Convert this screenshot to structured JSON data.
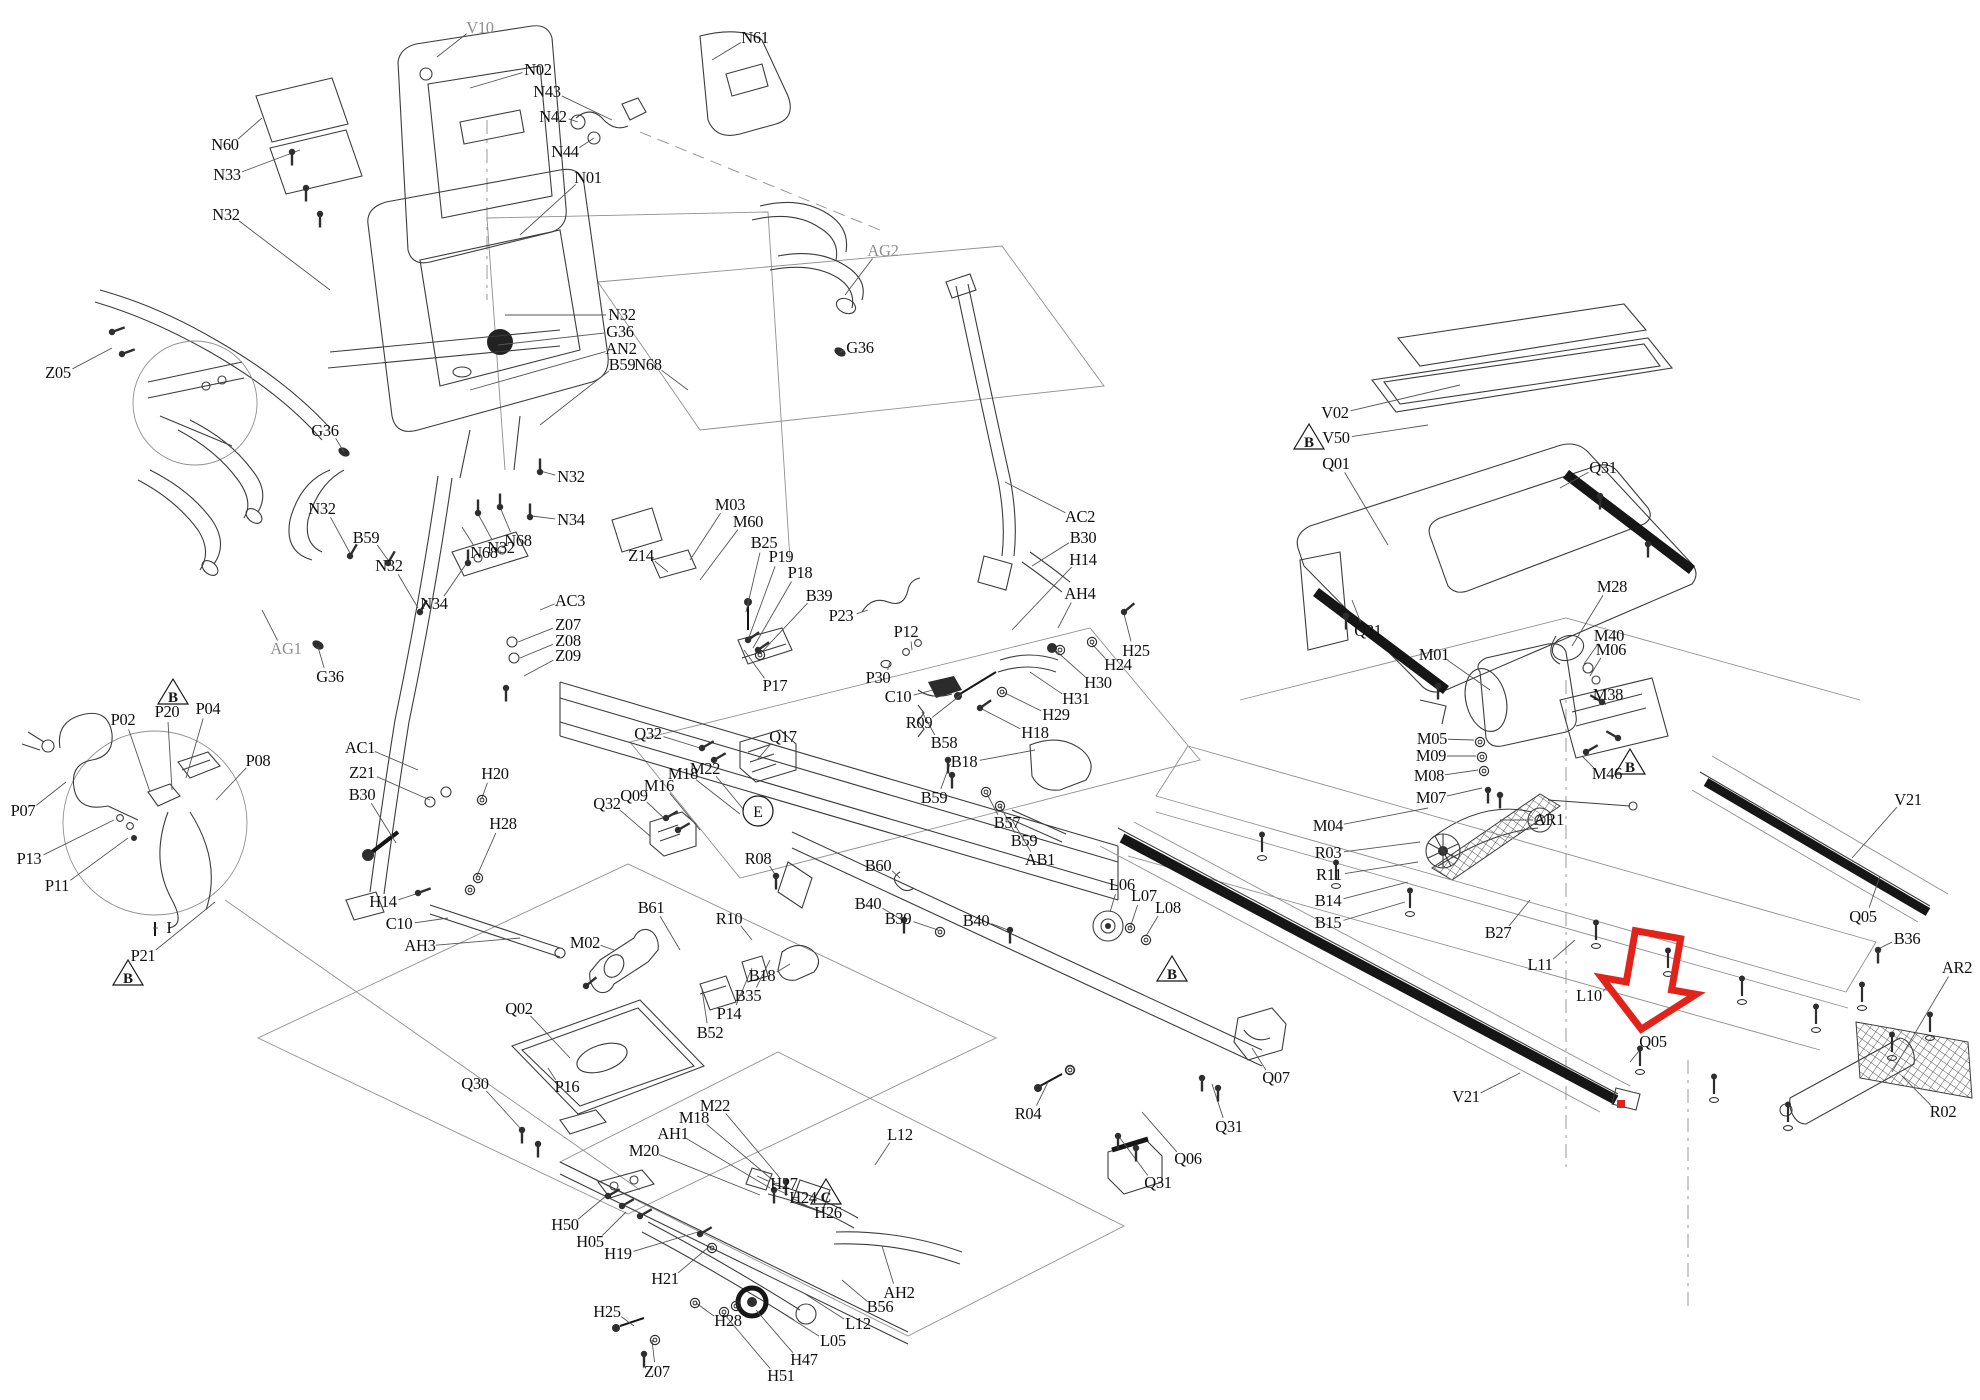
{
  "figure": {
    "type": "exploded-parts-diagram",
    "subject": "treadmill assembly"
  },
  "highlight": {
    "color": "#e2231a",
    "arrow": {
      "x": 1650,
      "y": 980,
      "rotate": 10
    },
    "dot": {
      "x": 1621,
      "y": 1104,
      "size": 8
    }
  },
  "markers": {
    "triangles": [
      {
        "x": 173,
        "y": 693,
        "letter": "B"
      },
      {
        "x": 128,
        "y": 974,
        "letter": "B"
      },
      {
        "x": 826,
        "y": 1193,
        "letter": "C"
      },
      {
        "x": 1172,
        "y": 970,
        "letter": "B"
      },
      {
        "x": 1309,
        "y": 438,
        "letter": "B"
      },
      {
        "x": 1630,
        "y": 763,
        "letter": "B"
      }
    ],
    "circles": [
      {
        "x": 758,
        "y": 811,
        "letter": "E"
      }
    ]
  },
  "labels": [
    {
      "t": "V10",
      "x": 480,
      "y": 28,
      "l": [
        437,
        57
      ],
      "c": "gray"
    },
    {
      "t": "N02",
      "x": 538,
      "y": 70,
      "l": [
        470,
        88
      ]
    },
    {
      "t": "N43",
      "x": 547,
      "y": 92,
      "l": [
        612,
        120
      ]
    },
    {
      "t": "N42",
      "x": 553,
      "y": 117,
      "l": [
        578,
        122
      ]
    },
    {
      "t": "N44",
      "x": 565,
      "y": 152,
      "l": [
        594,
        138
      ]
    },
    {
      "t": "N61",
      "x": 755,
      "y": 38,
      "l": [
        712,
        60
      ]
    },
    {
      "t": "N01",
      "x": 588,
      "y": 178,
      "l": [
        520,
        235
      ]
    },
    {
      "t": "N60",
      "x": 225,
      "y": 145,
      "l": [
        262,
        118
      ]
    },
    {
      "t": "N33",
      "x": 227,
      "y": 175,
      "l": [
        300,
        150
      ]
    },
    {
      "t": "N32",
      "x": 226,
      "y": 215,
      "l": [
        330,
        290
      ]
    },
    {
      "t": "N32",
      "x": 622,
      "y": 315,
      "l": [
        505,
        315
      ]
    },
    {
      "t": "G36",
      "x": 620,
      "y": 332,
      "l": [
        498,
        345
      ]
    },
    {
      "t": "AN2",
      "x": 621,
      "y": 349,
      "l": [
        470,
        390
      ]
    },
    {
      "t": "B59",
      "x": 622,
      "y": 365,
      "l": [
        540,
        425
      ]
    },
    {
      "t": "N68",
      "x": 648,
      "y": 365,
      "l": [
        688,
        390
      ]
    },
    {
      "t": "G36",
      "x": 860,
      "y": 348,
      "l": [
        840,
        352
      ]
    },
    {
      "t": "AG2",
      "x": 883,
      "y": 251,
      "l": [
        845,
        295
      ],
      "c": "gray"
    },
    {
      "t": "Z05",
      "x": 58,
      "y": 373,
      "l": [
        112,
        348
      ]
    },
    {
      "t": "G36",
      "x": 325,
      "y": 431,
      "l": [
        344,
        452
      ]
    },
    {
      "t": "N32",
      "x": 322,
      "y": 509,
      "l": [
        350,
        553
      ]
    },
    {
      "t": "B59",
      "x": 366,
      "y": 538,
      "l": [
        388,
        560
      ]
    },
    {
      "t": "N32",
      "x": 389,
      "y": 566,
      "l": [
        418,
        608
      ]
    },
    {
      "t": "N34",
      "x": 434,
      "y": 604,
      "l": [
        466,
        564
      ]
    },
    {
      "t": "N68",
      "x": 484,
      "y": 553,
      "l": [
        462,
        527
      ]
    },
    {
      "t": "N32",
      "x": 501,
      "y": 548,
      "l": [
        478,
        514
      ]
    },
    {
      "t": "N68",
      "x": 518,
      "y": 541,
      "l": [
        500,
        507
      ]
    },
    {
      "t": "N32",
      "x": 571,
      "y": 477,
      "l": [
        540,
        471
      ]
    },
    {
      "t": "N34",
      "x": 571,
      "y": 520,
      "l": [
        532,
        516
      ]
    },
    {
      "t": "AC3",
      "x": 570,
      "y": 601,
      "l": [
        540,
        610
      ]
    },
    {
      "t": "Z07",
      "x": 568,
      "y": 625,
      "l": [
        518,
        642
      ]
    },
    {
      "t": "Z08",
      "x": 568,
      "y": 641,
      "l": [
        520,
        658
      ]
    },
    {
      "t": "Z09",
      "x": 568,
      "y": 656,
      "l": [
        524,
        676
      ]
    },
    {
      "t": "AG1",
      "x": 286,
      "y": 649,
      "l": [
        262,
        610
      ],
      "c": "gray"
    },
    {
      "t": "G36",
      "x": 330,
      "y": 677,
      "l": [
        318,
        647
      ]
    },
    {
      "t": "Z14",
      "x": 641,
      "y": 556,
      "l": [
        668,
        572
      ]
    },
    {
      "t": "M03",
      "x": 730,
      "y": 505,
      "l": [
        690,
        560
      ]
    },
    {
      "t": "M60",
      "x": 748,
      "y": 522,
      "l": [
        700,
        580
      ]
    },
    {
      "t": "B25",
      "x": 764,
      "y": 543,
      "l": [
        746,
        612
      ]
    },
    {
      "t": "P19",
      "x": 781,
      "y": 557,
      "l": [
        748,
        640
      ]
    },
    {
      "t": "P18",
      "x": 800,
      "y": 573,
      "l": [
        753,
        648
      ]
    },
    {
      "t": "B39",
      "x": 819,
      "y": 596,
      "l": [
        760,
        654
      ]
    },
    {
      "t": "P23",
      "x": 841,
      "y": 616,
      "l": [
        868,
        610
      ]
    },
    {
      "t": "P12",
      "x": 906,
      "y": 632,
      "l": [
        912,
        650
      ]
    },
    {
      "t": "P30",
      "x": 878,
      "y": 678,
      "l": [
        890,
        662
      ]
    },
    {
      "t": "C10",
      "x": 898,
      "y": 697,
      "l": [
        933,
        690
      ]
    },
    {
      "t": "P17",
      "x": 775,
      "y": 686,
      "l": [
        744,
        650
      ]
    },
    {
      "t": "R09",
      "x": 919,
      "y": 723,
      "l": [
        962,
        694
      ]
    },
    {
      "t": "AC2",
      "x": 1080,
      "y": 517,
      "l": [
        1005,
        482
      ]
    },
    {
      "t": "B30",
      "x": 1083,
      "y": 538,
      "l": [
        1032,
        566
      ]
    },
    {
      "t": "H14",
      "x": 1083,
      "y": 560,
      "l": [
        1012,
        630
      ]
    },
    {
      "t": "AH4",
      "x": 1080,
      "y": 594,
      "l": [
        1058,
        628
      ]
    },
    {
      "t": "H25",
      "x": 1136,
      "y": 651,
      "l": [
        1124,
        614
      ]
    },
    {
      "t": "H24",
      "x": 1118,
      "y": 665,
      "l": [
        1092,
        644
      ]
    },
    {
      "t": "H30",
      "x": 1098,
      "y": 683,
      "l": [
        1055,
        650
      ]
    },
    {
      "t": "H31",
      "x": 1076,
      "y": 699,
      "l": [
        1030,
        672
      ]
    },
    {
      "t": "H29",
      "x": 1056,
      "y": 715,
      "l": [
        1003,
        692
      ]
    },
    {
      "t": "H18",
      "x": 1035,
      "y": 733,
      "l": [
        980,
        708
      ]
    },
    {
      "t": "B58",
      "x": 944,
      "y": 743,
      "l": [
        922,
        712
      ]
    },
    {
      "t": "B18",
      "x": 964,
      "y": 762,
      "l": [
        1035,
        750
      ]
    },
    {
      "t": "B59",
      "x": 934,
      "y": 798,
      "l": [
        950,
        764
      ]
    },
    {
      "t": "B57",
      "x": 1007,
      "y": 823,
      "l": [
        987,
        794
      ]
    },
    {
      "t": "B59",
      "x": 1024,
      "y": 841,
      "l": [
        1000,
        806
      ]
    },
    {
      "t": "AB1",
      "x": 1040,
      "y": 860,
      "l": [
        1012,
        820
      ]
    },
    {
      "t": "B60",
      "x": 878,
      "y": 866,
      "l": [
        900,
        878
      ]
    },
    {
      "t": "B40",
      "x": 868,
      "y": 904,
      "l": [
        902,
        920
      ]
    },
    {
      "t": "B39",
      "x": 898,
      "y": 919,
      "l": [
        938,
        930
      ]
    },
    {
      "t": "B40",
      "x": 976,
      "y": 921,
      "l": [
        1008,
        930
      ]
    },
    {
      "t": "L06",
      "x": 1122,
      "y": 885,
      "l": [
        1110,
        912
      ]
    },
    {
      "t": "L07",
      "x": 1144,
      "y": 896,
      "l": [
        1130,
        928
      ]
    },
    {
      "t": "L08",
      "x": 1168,
      "y": 908,
      "l": [
        1146,
        936
      ]
    },
    {
      "t": "AC1",
      "x": 360,
      "y": 748,
      "l": [
        418,
        770
      ]
    },
    {
      "t": "Z21",
      "x": 362,
      "y": 773,
      "l": [
        430,
        800
      ]
    },
    {
      "t": "B30",
      "x": 362,
      "y": 795,
      "l": [
        396,
        843
      ]
    },
    {
      "t": "H20",
      "x": 495,
      "y": 774,
      "l": [
        482,
        798
      ]
    },
    {
      "t": "H28",
      "x": 503,
      "y": 824,
      "l": [
        476,
        878
      ]
    },
    {
      "t": "H14",
      "x": 383,
      "y": 902,
      "l": [
        416,
        894
      ]
    },
    {
      "t": "C10",
      "x": 399,
      "y": 924,
      "l": [
        448,
        918
      ]
    },
    {
      "t": "AH3",
      "x": 420,
      "y": 946,
      "l": [
        520,
        938
      ]
    },
    {
      "t": "Q32",
      "x": 648,
      "y": 734,
      "l": [
        700,
        748
      ]
    },
    {
      "t": "Q17",
      "x": 783,
      "y": 737,
      "l": [
        757,
        760
      ]
    },
    {
      "t": "M22",
      "x": 705,
      "y": 769,
      "l": [
        744,
        810
      ]
    },
    {
      "t": "M18",
      "x": 683,
      "y": 774,
      "l": [
        740,
        814
      ]
    },
    {
      "t": "M16",
      "x": 659,
      "y": 786,
      "l": [
        700,
        830
      ]
    },
    {
      "t": "Q09",
      "x": 634,
      "y": 796,
      "l": [
        666,
        820
      ]
    },
    {
      "t": "Q32",
      "x": 607,
      "y": 804,
      "l": [
        650,
        836
      ]
    },
    {
      "t": "R08",
      "x": 758,
      "y": 859,
      "l": [
        776,
        876
      ]
    },
    {
      "t": "R10",
      "x": 729,
      "y": 919,
      "l": [
        752,
        940
      ]
    },
    {
      "t": "B61",
      "x": 651,
      "y": 908,
      "l": [
        680,
        950
      ]
    },
    {
      "t": "M02",
      "x": 585,
      "y": 943,
      "l": [
        614,
        950
      ]
    },
    {
      "t": "B18",
      "x": 762,
      "y": 976,
      "l": [
        790,
        964
      ]
    },
    {
      "t": "B35",
      "x": 748,
      "y": 996,
      "l": [
        770,
        960
      ]
    },
    {
      "t": "P14",
      "x": 729,
      "y": 1014,
      "l": [
        752,
        968
      ]
    },
    {
      "t": "B52",
      "x": 710,
      "y": 1033,
      "l": [
        702,
        990
      ]
    },
    {
      "t": "Q02",
      "x": 519,
      "y": 1009,
      "l": [
        570,
        1058
      ]
    },
    {
      "t": "P16",
      "x": 567,
      "y": 1087,
      "l": [
        548,
        1068
      ]
    },
    {
      "t": "Q30",
      "x": 475,
      "y": 1084,
      "l": [
        520,
        1128
      ]
    },
    {
      "t": "M22",
      "x": 715,
      "y": 1106,
      "l": [
        780,
        1178
      ]
    },
    {
      "t": "M18",
      "x": 694,
      "y": 1118,
      "l": [
        775,
        1182
      ]
    },
    {
      "t": "AH1",
      "x": 673,
      "y": 1134,
      "l": [
        770,
        1188
      ]
    },
    {
      "t": "M20",
      "x": 644,
      "y": 1151,
      "l": [
        760,
        1195
      ]
    },
    {
      "t": "L12",
      "x": 900,
      "y": 1135,
      "l": [
        875,
        1165
      ]
    },
    {
      "t": "H27",
      "x": 784,
      "y": 1184,
      "l": [
        757,
        1176
      ]
    },
    {
      "t": "H24",
      "x": 803,
      "y": 1198,
      "l": [
        774,
        1188
      ]
    },
    {
      "t": "H26",
      "x": 828,
      "y": 1213,
      "l": [
        792,
        1198
      ]
    },
    {
      "t": "H50",
      "x": 565,
      "y": 1225,
      "l": [
        606,
        1196
      ]
    },
    {
      "t": "H05",
      "x": 590,
      "y": 1242,
      "l": [
        626,
        1212
      ]
    },
    {
      "t": "H19",
      "x": 618,
      "y": 1254,
      "l": [
        698,
        1232
      ]
    },
    {
      "t": "H21",
      "x": 665,
      "y": 1279,
      "l": [
        710,
        1246
      ]
    },
    {
      "t": "H25",
      "x": 607,
      "y": 1312,
      "l": [
        634,
        1326
      ]
    },
    {
      "t": "H28",
      "x": 728,
      "y": 1321,
      "l": [
        696,
        1303
      ]
    },
    {
      "t": "Z07",
      "x": 657,
      "y": 1372,
      "l": [
        652,
        1340
      ]
    },
    {
      "t": "H51",
      "x": 781,
      "y": 1376,
      "l": [
        724,
        1314
      ]
    },
    {
      "t": "H47",
      "x": 804,
      "y": 1360,
      "l": [
        756,
        1310
      ]
    },
    {
      "t": "L05",
      "x": 833,
      "y": 1341,
      "l": [
        784,
        1314
      ]
    },
    {
      "t": "L12",
      "x": 858,
      "y": 1324,
      "l": [
        802,
        1292
      ]
    },
    {
      "t": "B56",
      "x": 880,
      "y": 1307,
      "l": [
        842,
        1280
      ]
    },
    {
      "t": "AH2",
      "x": 899,
      "y": 1293,
      "l": [
        882,
        1246
      ]
    },
    {
      "t": "R04",
      "x": 1028,
      "y": 1114,
      "l": [
        1048,
        1082
      ]
    },
    {
      "t": "Q06",
      "x": 1188,
      "y": 1159,
      "l": [
        1142,
        1112
      ]
    },
    {
      "t": "Q31",
      "x": 1158,
      "y": 1183,
      "l": [
        1120,
        1138
      ]
    },
    {
      "t": "Q31",
      "x": 1229,
      "y": 1127,
      "l": [
        1212,
        1084
      ]
    },
    {
      "t": "Q07",
      "x": 1276,
      "y": 1078,
      "l": [
        1252,
        1048
      ]
    },
    {
      "t": "P02",
      "x": 123,
      "y": 720,
      "l": [
        150,
        792
      ]
    },
    {
      "t": "P20",
      "x": 167,
      "y": 712,
      "l": [
        172,
        790
      ]
    },
    {
      "t": "P04",
      "x": 208,
      "y": 709,
      "l": [
        186,
        778
      ]
    },
    {
      "t": "P08",
      "x": 258,
      "y": 761,
      "l": [
        216,
        800
      ]
    },
    {
      "t": "P07",
      "x": 23,
      "y": 811,
      "l": [
        66,
        782
      ]
    },
    {
      "t": "P13",
      "x": 29,
      "y": 859,
      "l": [
        114,
        820
      ]
    },
    {
      "t": "P11",
      "x": 57,
      "y": 886,
      "l": [
        128,
        838
      ]
    },
    {
      "t": "I",
      "x": 169,
      "y": 928,
      "l": [
        158,
        928
      ]
    },
    {
      "t": "P21",
      "x": 143,
      "y": 956,
      "l": [
        215,
        902
      ]
    },
    {
      "t": "V02",
      "x": 1335,
      "y": 413,
      "l": [
        1460,
        385
      ]
    },
    {
      "t": "V50",
      "x": 1336,
      "y": 438,
      "l": [
        1428,
        425
      ]
    },
    {
      "t": "Q01",
      "x": 1336,
      "y": 464,
      "l": [
        1388,
        545
      ]
    },
    {
      "t": "Q31",
      "x": 1603,
      "y": 468,
      "l": [
        1560,
        488
      ]
    },
    {
      "t": "Q31",
      "x": 1368,
      "y": 631,
      "l": [
        1352,
        600
      ]
    },
    {
      "t": "M28",
      "x": 1612,
      "y": 587,
      "l": [
        1572,
        646
      ]
    },
    {
      "t": "M40",
      "x": 1609,
      "y": 636,
      "l": [
        1584,
        664
      ]
    },
    {
      "t": "M06",
      "x": 1611,
      "y": 650,
      "l": [
        1590,
        676
      ]
    },
    {
      "t": "M01",
      "x": 1434,
      "y": 655,
      "l": [
        1490,
        690
      ]
    },
    {
      "t": "M38",
      "x": 1608,
      "y": 695,
      "l": [
        1606,
        704
      ]
    },
    {
      "t": "M05",
      "x": 1432,
      "y": 739,
      "l": [
        1474,
        740
      ]
    },
    {
      "t": "M09",
      "x": 1431,
      "y": 756,
      "l": [
        1476,
        756
      ]
    },
    {
      "t": "M08",
      "x": 1429,
      "y": 776,
      "l": [
        1478,
        770
      ]
    },
    {
      "t": "M07",
      "x": 1431,
      "y": 798,
      "l": [
        1482,
        788
      ]
    },
    {
      "t": "M46",
      "x": 1607,
      "y": 774,
      "l": [
        1582,
        756
      ]
    },
    {
      "t": "M04",
      "x": 1328,
      "y": 826,
      "l": [
        1428,
        808
      ]
    },
    {
      "t": "R03",
      "x": 1328,
      "y": 853,
      "l": [
        1420,
        842
      ]
    },
    {
      "t": "R11",
      "x": 1329,
      "y": 875,
      "l": [
        1418,
        862
      ]
    },
    {
      "t": "B14",
      "x": 1328,
      "y": 901,
      "l": [
        1408,
        882
      ]
    },
    {
      "t": "B15",
      "x": 1328,
      "y": 923,
      "l": [
        1405,
        902
      ]
    },
    {
      "t": "AR1",
      "x": 1549,
      "y": 820,
      "l": [
        1500,
        820
      ]
    },
    {
      "t": "B27",
      "x": 1498,
      "y": 933,
      "l": [
        1530,
        900
      ]
    },
    {
      "t": "L11",
      "x": 1540,
      "y": 965,
      "l": [
        1575,
        940
      ]
    },
    {
      "t": "L10",
      "x": 1589,
      "y": 996,
      "l": [
        1608,
        986
      ]
    },
    {
      "t": "V21",
      "x": 1908,
      "y": 800,
      "l": [
        1852,
        858
      ]
    },
    {
      "t": "Q05",
      "x": 1863,
      "y": 917,
      "l": [
        1880,
        876
      ]
    },
    {
      "t": "B36",
      "x": 1907,
      "y": 939,
      "l": [
        1880,
        948
      ]
    },
    {
      "t": "AR2",
      "x": 1957,
      "y": 968,
      "l": [
        1892,
        1072
      ]
    },
    {
      "t": "R02",
      "x": 1943,
      "y": 1112,
      "l": [
        1902,
        1076
      ]
    },
    {
      "t": "V21",
      "x": 1466,
      "y": 1097,
      "l": [
        1520,
        1073
      ]
    },
    {
      "t": "Q05",
      "x": 1653,
      "y": 1042,
      "l": [
        1630,
        1062
      ]
    }
  ]
}
